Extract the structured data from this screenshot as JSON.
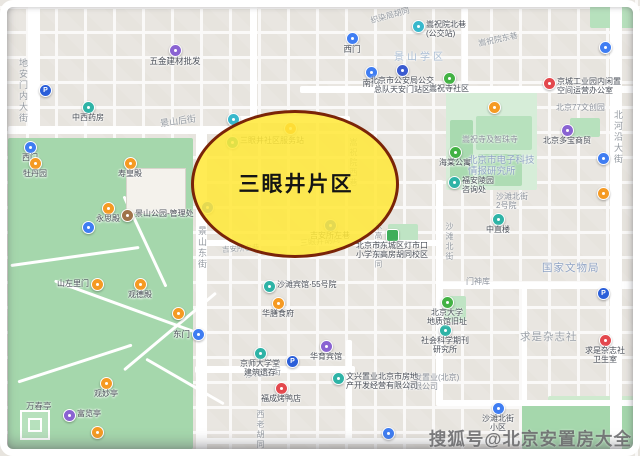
{
  "region_label": {
    "text": "三眼井片区"
  },
  "watermark": {
    "text": "搜狐号@北京安置房大全"
  },
  "map": {
    "streets": [
      {
        "t": "地安门内大街",
        "x": 17,
        "y": 58,
        "v": 1
      },
      {
        "t": "景山后街",
        "x": 160,
        "y": 114,
        "r": -8
      },
      {
        "t": "织染局胡同",
        "x": 370,
        "y": 10,
        "r": -16,
        "fs": 8
      },
      {
        "t": "嵩祝院东巷",
        "x": 478,
        "y": 34,
        "r": -12,
        "fs": 8
      },
      {
        "t": "景山东街",
        "x": 196,
        "y": 226,
        "v": 1
      },
      {
        "t": "三眼井胡同",
        "x": 300,
        "y": 236,
        "r": -5,
        "fs": 8
      },
      {
        "t": "吉安所右巷",
        "x": 222,
        "y": 243,
        "r": -4,
        "fs": 7.5
      },
      {
        "t": "沙滩后街",
        "x": 245,
        "y": 366,
        "r": -5
      },
      {
        "t": "西老胡同",
        "x": 255,
        "y": 410,
        "v": 1,
        "fs": 8
      },
      {
        "t": "沙滩北街",
        "x": 444,
        "y": 222,
        "v": 1,
        "fs": 8
      },
      {
        "t": "北河沿大街",
        "x": 612,
        "y": 110,
        "v": 1
      },
      {
        "t": "东高房胡同",
        "x": 373,
        "y": 222,
        "v": 1,
        "fs": 7.5
      },
      {
        "t": "嵩祝院西巷",
        "x": 348,
        "y": 138,
        "v": 1,
        "fs": 8
      }
    ],
    "places": [
      {
        "t": "景山学区",
        "x": 394,
        "y": 52,
        "cls": "district"
      },
      {
        "t": "嵩祝寺及智珠寺",
        "x": 462,
        "y": 135,
        "cls": "tiny"
      },
      {
        "t": "北京市电子科技\n情报研究所",
        "x": 468,
        "y": 156,
        "cls": "inst"
      },
      {
        "t": "沙滩北街\n2号院",
        "x": 496,
        "y": 192,
        "cls": "tiny"
      },
      {
        "t": "国家文物局",
        "x": 542,
        "y": 262,
        "cls": "inst2"
      },
      {
        "t": "求是杂志社",
        "x": 520,
        "y": 331,
        "cls": "big-gray"
      },
      {
        "t": "门神库",
        "x": 466,
        "y": 277,
        "cls": "tiny"
      },
      {
        "t": "北京77文创园",
        "x": 556,
        "y": 103,
        "cls": "tiny"
      },
      {
        "t": "万春亭",
        "x": 26,
        "y": 402,
        "cls": "tiny-dark"
      },
      {
        "t": "广发置业(北京)\n有限公司",
        "x": 406,
        "y": 373,
        "cls": "tiny"
      }
    ],
    "pois": [
      {
        "x": 352,
        "y": 38,
        "c": "blue",
        "t": "西门",
        "lp": "b"
      },
      {
        "x": 371,
        "y": 72,
        "c": "blue",
        "t": "南门",
        "lp": "b"
      },
      {
        "x": 418,
        "y": 26,
        "c": "teal2",
        "t": "嵩祝院北巷\n(公交站)",
        "lp": "r",
        "fs": 8
      },
      {
        "x": 605,
        "y": 47,
        "c": "blue",
        "t": ""
      },
      {
        "x": 207,
        "y": 207,
        "c": "blue",
        "t": ""
      },
      {
        "x": 233,
        "y": 119,
        "c": "teal2",
        "t": ""
      },
      {
        "x": 198,
        "y": 334,
        "c": "blue",
        "t": "东门",
        "lp": "l"
      },
      {
        "x": 388,
        "y": 433,
        "c": "blue",
        "t": ""
      },
      {
        "x": 498,
        "y": 408,
        "c": "blue",
        "t": "沙滩北街\n小区",
        "lp": "b",
        "fs": 8
      },
      {
        "x": 30,
        "y": 147,
        "c": "blue",
        "t": "西门",
        "lp": "b",
        "fs": 8
      },
      {
        "x": 88,
        "y": 227,
        "c": "blue",
        "t": ""
      },
      {
        "x": 603,
        "y": 158,
        "c": "blue",
        "t": ""
      },
      {
        "x": 45,
        "y": 90,
        "c": "park",
        "t": "P"
      },
      {
        "x": 292,
        "y": 361,
        "c": "park",
        "t": "P"
      },
      {
        "x": 603,
        "y": 293,
        "c": "park",
        "t": "P"
      },
      {
        "x": 175,
        "y": 50,
        "c": "purple",
        "t": "五金建材批发",
        "lp": "b"
      },
      {
        "x": 326,
        "y": 346,
        "c": "purple",
        "t": "华育宾馆",
        "lp": "b",
        "fs": 8
      },
      {
        "x": 567,
        "y": 130,
        "c": "purple",
        "t": "北京多宝商贸",
        "lp": "b",
        "fs": 8
      },
      {
        "x": 69,
        "y": 415,
        "c": "purple",
        "t": "富览亭",
        "lp": "r",
        "fs": 8
      },
      {
        "x": 402,
        "y": 70,
        "c": "navy",
        "t": "北京市公安局公交\n总队天安门站区",
        "lp": "b",
        "fs": 8
      },
      {
        "x": 269,
        "y": 286,
        "c": "teal",
        "t": "沙滩宾馆·55号院",
        "lp": "r",
        "fs": 8
      },
      {
        "x": 260,
        "y": 353,
        "c": "teal",
        "t": "京师大学堂\n建筑遗存",
        "lp": "b",
        "fs": 8
      },
      {
        "x": 338,
        "y": 378,
        "c": "teal",
        "t": "文兴置业北京市房地\n产开发经营有限公司",
        "lp": "r",
        "fs": 8
      },
      {
        "x": 454,
        "y": 182,
        "c": "teal",
        "t": "福安陵园\n咨询处",
        "lp": "r",
        "fs": 8
      },
      {
        "x": 445,
        "y": 330,
        "c": "teal",
        "t": "社会科学期刊\n研究所",
        "lp": "b",
        "fs": 8
      },
      {
        "x": 88,
        "y": 107,
        "c": "teal",
        "t": "中西药房",
        "lp": "b",
        "fs": 8
      },
      {
        "x": 498,
        "y": 219,
        "c": "teal",
        "t": "中直楼",
        "lp": "b",
        "fs": 8
      },
      {
        "x": 449,
        "y": 78,
        "c": "green",
        "t": "嵩祝寺社区",
        "lp": "b",
        "fs": 8
      },
      {
        "x": 455,
        "y": 152,
        "c": "green",
        "t": "海棠公寓",
        "lp": "b",
        "fs": 8
      },
      {
        "x": 447,
        "y": 302,
        "c": "green",
        "t": "北京大学\n地质馆旧址",
        "lp": "b",
        "fs": 8
      },
      {
        "x": 392,
        "y": 235,
        "c": "school",
        "t": "北京市东城区灯市口\n小学东高房胡同校区",
        "lp": "b",
        "fs": 8
      },
      {
        "x": 35,
        "y": 163,
        "c": "orange",
        "t": "牡丹园",
        "lp": "b",
        "fs": 8
      },
      {
        "x": 130,
        "y": 163,
        "c": "orange",
        "t": "寿皇殿",
        "lp": "b",
        "fs": 8
      },
      {
        "x": 108,
        "y": 208,
        "c": "orange",
        "t": "永思殿",
        "lp": "b",
        "fs": 8
      },
      {
        "x": 97,
        "y": 284,
        "c": "orange",
        "t": "山左里门",
        "lp": "l",
        "fs": 8
      },
      {
        "x": 140,
        "y": 284,
        "c": "orange",
        "t": "观德殿",
        "lp": "b",
        "fs": 8
      },
      {
        "x": 178,
        "y": 313,
        "c": "orange",
        "t": ""
      },
      {
        "x": 106,
        "y": 383,
        "c": "orange",
        "t": "观妙亭",
        "lp": "b",
        "fs": 8
      },
      {
        "x": 97,
        "y": 432,
        "c": "orange",
        "t": ""
      },
      {
        "x": 494,
        "y": 107,
        "c": "orange",
        "t": ""
      },
      {
        "x": 603,
        "y": 193,
        "c": "orange",
        "t": ""
      },
      {
        "x": 278,
        "y": 303,
        "c": "orange",
        "t": "华膳食府",
        "lp": "b",
        "fs": 8
      },
      {
        "x": 127,
        "y": 215,
        "c": "brown",
        "t": "景山公园-管理处",
        "lp": "r",
        "fs": 8
      },
      {
        "x": 549,
        "y": 83,
        "c": "red",
        "t": "京城工业园内闲置\n空间运营办公室",
        "lp": "r",
        "fs": 8
      },
      {
        "x": 605,
        "y": 340,
        "c": "red",
        "t": "求是杂志社\n卫生室",
        "lp": "b",
        "fs": 8
      },
      {
        "x": 281,
        "y": 388,
        "c": "red",
        "t": "福成烤鸭店",
        "lp": "b",
        "fs": 8
      },
      {
        "x": 232,
        "y": 142,
        "c": "teal",
        "t": "三眼井社区服务站",
        "lp": "r",
        "fs": 8
      },
      {
        "x": 290,
        "y": 128,
        "c": "orange",
        "t": ""
      },
      {
        "x": 330,
        "y": 225,
        "c": "blue",
        "t": "吉安所左巷",
        "lp": "b",
        "fs": 8
      }
    ]
  }
}
